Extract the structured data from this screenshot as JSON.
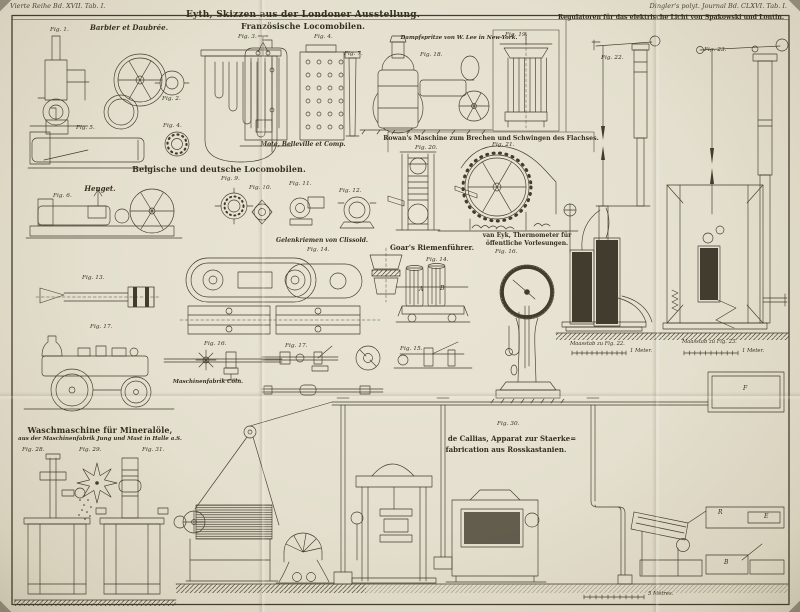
{
  "plate": {
    "margin_left": "Vierte Reihe Bd. XVII. Tab. I.",
    "margin_right": "Dingler's polyt. Journal Bd. CLXVI. Tab. I."
  },
  "sections": {
    "eyth": {
      "title": "Eyth, Skizzen aus der Londoner Ausstellung.",
      "subtitle": "Französische Locomobilen.",
      "maker_barbier": "Barbier et Daubrée.",
      "maker_mote": "Mote, Belleville et Comp."
    },
    "belgisch": {
      "title": "Belgische und deutsche Locomobilen.",
      "maker_henget": "Henget."
    },
    "dampfspritze": {
      "title": "Dampfspritze von W. Lee in New-York."
    },
    "regulatoren": {
      "title": "Regulatoren für das elektrische Licht von Spakowski und Lontin."
    },
    "rowan": {
      "title": "Rowan's Maschine zum Brechen und Schwingen des Flachses."
    },
    "clissold": {
      "title": "Gelenkriemen von Clissold.",
      "maker_coeln": "Maschinenfabrik Cöln."
    },
    "goar": {
      "title": "Goar's Riemenführer."
    },
    "vaneyk": {
      "title_line1": "van Eyk, Thermometer für",
      "title_line2": "öffentliche Vorlesungen."
    },
    "waschmaschine": {
      "title": "Waschmaschine für Mineralöle,",
      "subtitle": "aus der Maschinenfabrik Jung und Mast in Halle a.S."
    },
    "callias": {
      "title_line1": "de Callias, Apparat zur Staerke=",
      "title_line2": "fabrication aus Rosskastanien."
    }
  },
  "figures": {
    "fig1": "Fig. 1.",
    "fig2": "Fig. 2.",
    "fig3": "Fig. 3.",
    "fig4a": "Fig. 4.",
    "fig4b": "Fig. 4.",
    "fig5": "Fig. 5.",
    "fig6": "Fig. 6.",
    "fig7": "Fig. 7.",
    "fig9": "Fig. 9.",
    "fig10": "Fig. 10.",
    "fig11": "Fig. 11.",
    "fig12": "Fig. 12.",
    "fig13": "Fig. 13.",
    "fig14_clissold": "Fig. 14.",
    "fig14_goar": "Fig. 14.",
    "fig15_goar": "Fig. 15.",
    "fig16_coeln": "Fig. 16.",
    "fig16_vaneyk": "Fig. 16.",
    "fig17_locomobile": "Fig. 17.",
    "fig17_coeln": "Fig. 17.",
    "fig18": "Fig. 18.",
    "fig19": "Fig. 19.",
    "fig20": "Fig. 20.",
    "fig21": "Fig. 21.",
    "fig22": "Fig. 22.",
    "fig23": "Fig. 23.",
    "fig28": "Fig. 28.",
    "fig29": "Fig. 29.",
    "fig30": "Fig. 30.",
    "fig31": "Fig. 31."
  },
  "scales": {
    "maasstab_fig22": "Maasstab zu Fig. 22.",
    "meter_fig22": "1 Meter.",
    "maasstab_fig23": "Maasstab zu Fig. 23.",
    "meter_fig23": "1 Meter.",
    "metres_bottom": "5 Mètres."
  },
  "part_letters": {
    "a": "A",
    "b": "B",
    "f": "F",
    "r": "R",
    "e": "E"
  },
  "colors": {
    "paper": "#e4dfce",
    "ink": "#3d392e"
  }
}
